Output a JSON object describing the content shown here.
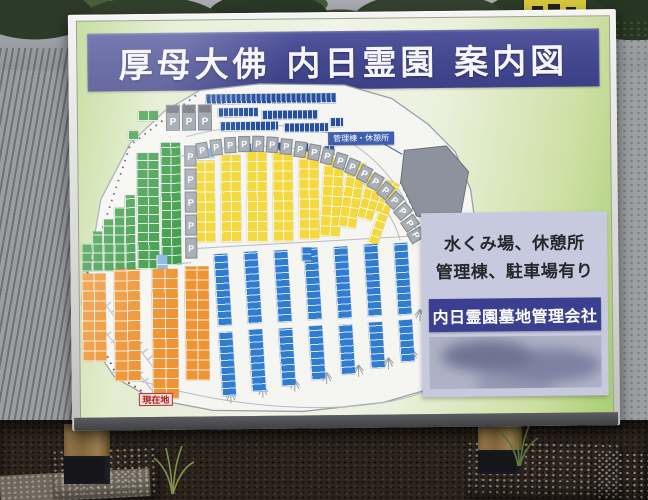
{
  "sign": {
    "title": "厚母大佛 内日霊園 案内図",
    "info_panel": {
      "line1": "水くみ場、休憩所",
      "line2": "管理棟、駐車場有り",
      "company": "内日霊園墓地管理会社"
    },
    "map": {
      "labels": {
        "building": "管理棟・休憩所",
        "current_location": "現在地",
        "parking": "P"
      },
      "colors": {
        "g": "#3C9A47",
        "n": "#26509F",
        "b": "#2F7CD0",
        "y": "#F3D83E",
        "o": "#EE9434",
        "lb": "#86B9E4"
      },
      "blocks": [
        [
          "g",
          2,
          222,
          10,
          28,
          10,
          9,
          0
        ],
        [
          "g",
          13,
          210,
          10,
          40,
          10,
          9,
          0
        ],
        [
          "g",
          24,
          198,
          10,
          52,
          10,
          9,
          0
        ],
        [
          "g",
          35,
          186,
          10,
          64,
          10,
          9,
          0
        ],
        [
          "g",
          46,
          174,
          10,
          76,
          10,
          9,
          0
        ],
        [
          "g",
          58,
          132,
          22,
          116,
          11,
          9,
          0
        ],
        [
          "g",
          82,
          122,
          20,
          122,
          10,
          9,
          0
        ],
        [
          "g",
          60,
          90,
          20,
          10,
          10,
          10,
          0
        ],
        [
          "g",
          50,
          110,
          10,
          9,
          10,
          9,
          0
        ],
        [
          "lb",
          77,
          234,
          11,
          20,
          11,
          10,
          0
        ],
        [
          "lb",
          116,
          128,
          20,
          10,
          10,
          10,
          0
        ],
        [
          "n",
          128,
          74,
          130,
          10,
          5,
          12,
          0
        ],
        [
          "n",
          140,
          88,
          40,
          9,
          5,
          12,
          0
        ],
        [
          "n",
          184,
          91,
          56,
          9,
          5,
          12,
          0
        ],
        [
          "n",
          142,
          102,
          58,
          9,
          5,
          12,
          0
        ],
        [
          "n",
          206,
          104,
          44,
          9,
          5,
          12,
          0
        ],
        [
          "n",
          252,
          99,
          13,
          9,
          5,
          12,
          0
        ],
        [
          "n",
          168,
          124,
          10,
          9,
          5,
          12,
          0
        ],
        [
          "n",
          194,
          123,
          10,
          9,
          5,
          12,
          0
        ],
        [
          "n",
          220,
          124,
          10,
          9,
          5,
          12,
          0
        ],
        [
          "n",
          246,
          127,
          10,
          9,
          5,
          12,
          0
        ],
        [
          "y",
          116,
          140,
          20,
          82,
          10,
          10,
          0
        ],
        [
          "y",
          142,
          135,
          20,
          87,
          10,
          10,
          0
        ],
        [
          "y",
          168,
          132,
          20,
          90,
          10,
          10,
          0
        ],
        [
          "y",
          194,
          131,
          20,
          91,
          10,
          10,
          0
        ],
        [
          "y",
          220,
          132,
          20,
          88,
          10,
          10,
          0
        ],
        [
          "y",
          246,
          135,
          20,
          82,
          10,
          10,
          4
        ],
        [
          "y",
          270,
          142,
          18,
          66,
          9,
          10,
          10
        ],
        [
          "y",
          290,
          154,
          16,
          46,
          8,
          10,
          16
        ],
        [
          "y",
          308,
          161,
          14,
          34,
          7,
          10,
          22
        ],
        [
          "y",
          300,
          192,
          10,
          42,
          10,
          8,
          20
        ],
        [
          "o",
          2,
          252,
          24,
          88,
          12,
          10,
          0
        ],
        [
          "o",
          34,
          248,
          26,
          112,
          13,
          10,
          0
        ],
        [
          "o",
          72,
          248,
          26,
          130,
          13,
          10,
          0
        ],
        [
          "o",
          105,
          246,
          24,
          114,
          12,
          10,
          0
        ],
        [
          "b",
          134,
          234,
          14,
          72,
          14,
          7,
          -3
        ],
        [
          "b",
          164,
          232,
          14,
          72,
          14,
          7,
          -3
        ],
        [
          "b",
          194,
          231,
          14,
          72,
          14,
          7,
          -3
        ],
        [
          "b",
          224,
          229,
          14,
          72,
          14,
          7,
          -3
        ],
        [
          "b",
          254,
          228,
          14,
          72,
          14,
          7,
          -3
        ],
        [
          "b",
          284,
          226,
          14,
          72,
          14,
          7,
          -3
        ],
        [
          "b",
          314,
          225,
          14,
          72,
          14,
          7,
          -3
        ],
        [
          "b",
          344,
          223,
          14,
          72,
          14,
          7,
          -3
        ],
        [
          "b",
          138,
          312,
          14,
          64,
          14,
          7,
          -3
        ],
        [
          "b",
          168,
          310,
          14,
          62,
          14,
          7,
          -3
        ],
        [
          "b",
          198,
          309,
          14,
          58,
          14,
          7,
          -3
        ],
        [
          "b",
          228,
          307,
          14,
          54,
          14,
          7,
          -3
        ],
        [
          "b",
          258,
          306,
          14,
          50,
          14,
          7,
          -3
        ],
        [
          "b",
          288,
          304,
          14,
          46,
          14,
          7,
          -3
        ],
        [
          "b",
          318,
          302,
          14,
          42,
          14,
          7,
          -3
        ],
        [
          "b",
          348,
          300,
          14,
          38,
          14,
          7,
          -3
        ],
        [
          "b",
          222,
          228,
          10,
          14,
          10,
          7,
          0
        ]
      ],
      "parking_big": [
        [
          88,
          84
        ],
        [
          104,
          84
        ],
        [
          120,
          84
        ]
      ],
      "parking_column": [
        [
          106,
          125
        ],
        [
          106,
          148
        ],
        [
          106,
          171
        ],
        [
          106,
          194
        ],
        [
          106,
          217
        ]
      ],
      "parking_curve": [
        [
          118,
          122,
          -8
        ],
        [
          132,
          119,
          -5
        ],
        [
          146,
          117,
          -2
        ],
        [
          160,
          116,
          0
        ],
        [
          174,
          116,
          2
        ],
        [
          188,
          117,
          4
        ],
        [
          202,
          119,
          6
        ],
        [
          216,
          122,
          8
        ],
        [
          230,
          125,
          11
        ],
        [
          243,
          129,
          14
        ],
        [
          256,
          134,
          18
        ],
        [
          268,
          140,
          22
        ],
        [
          280,
          147,
          27
        ],
        [
          291,
          155,
          32
        ],
        [
          301,
          164,
          38
        ],
        [
          310,
          174,
          44
        ],
        [
          318,
          185,
          50
        ],
        [
          325,
          197,
          55
        ],
        [
          331,
          209,
          60
        ]
      ],
      "trees": [
        [
          150,
          380
        ],
        [
          182,
          375
        ],
        [
          214,
          369
        ],
        [
          246,
          362
        ],
        [
          278,
          355
        ],
        [
          308,
          348
        ],
        [
          332,
          340
        ],
        [
          340,
          300
        ],
        [
          352,
          318
        ]
      ]
    }
  }
}
